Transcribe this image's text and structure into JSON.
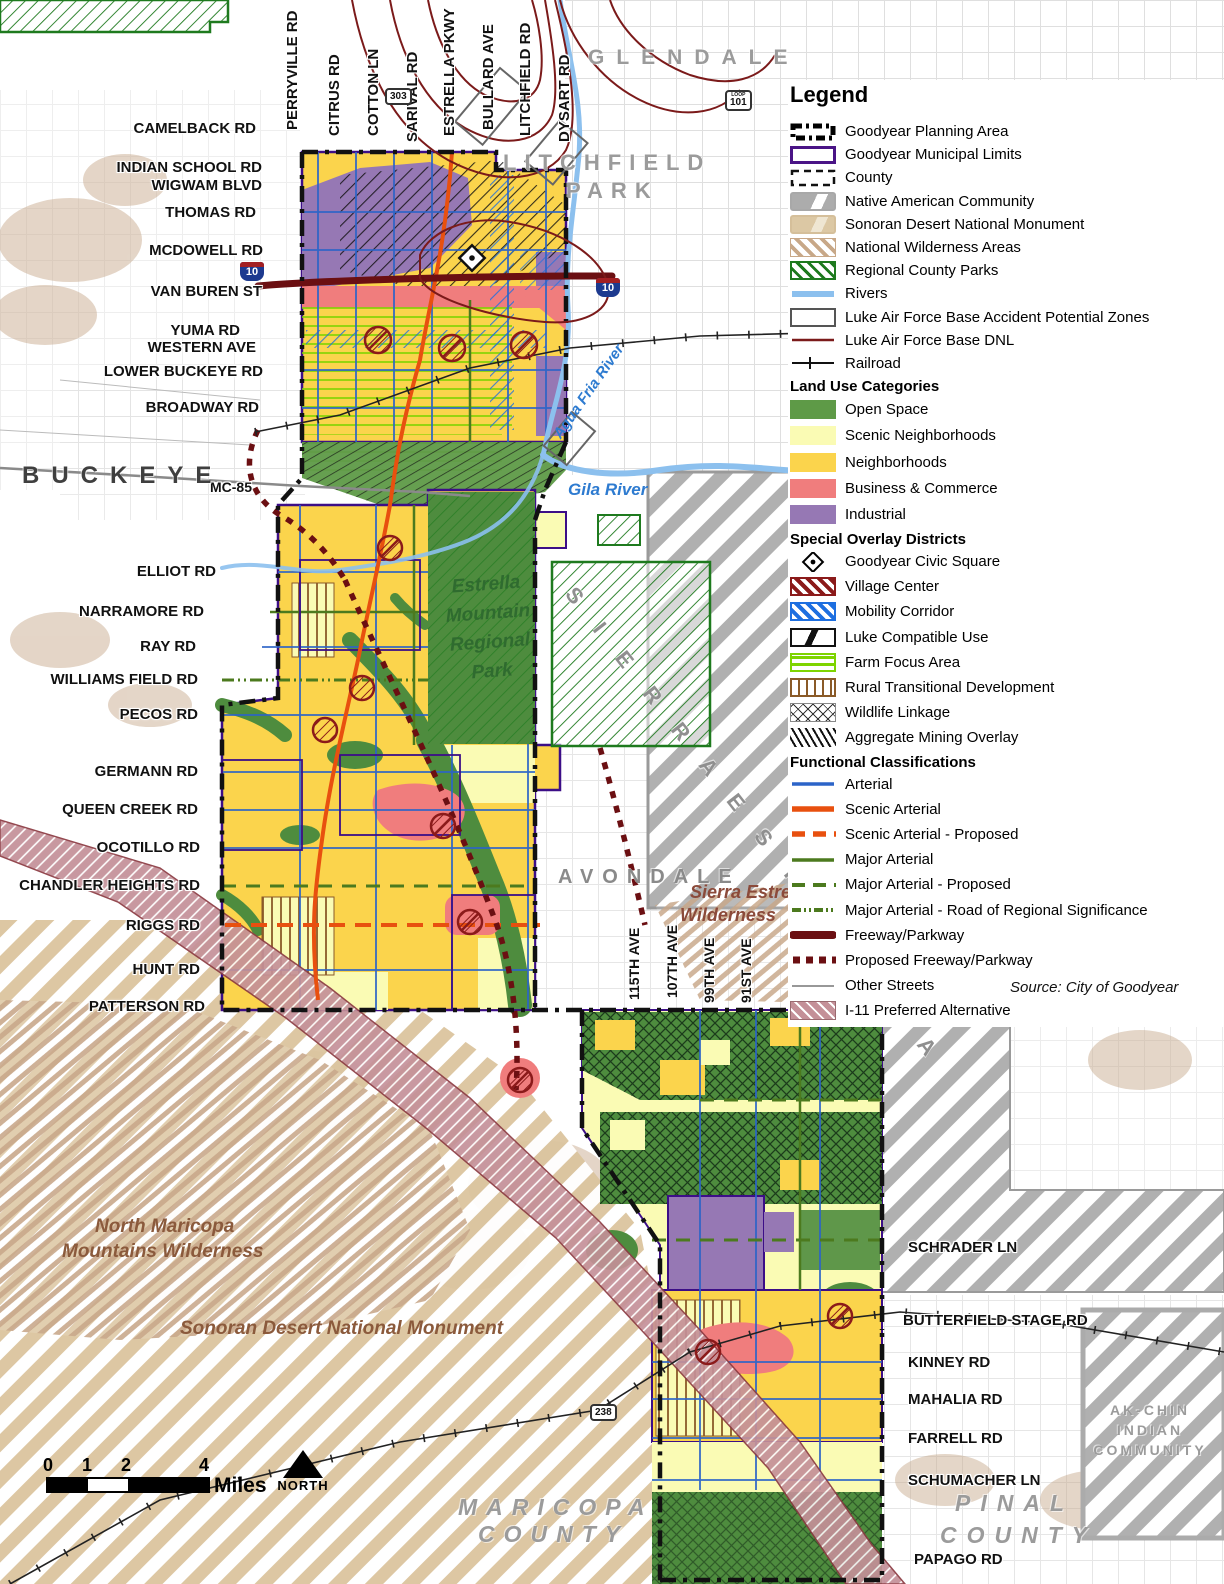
{
  "legend": {
    "title": "Legend",
    "headers": {
      "land_use": "Land Use Categories",
      "overlay": "Special Overlay Districts",
      "functional": "Functional Classifications"
    },
    "items": [
      "Goodyear Planning Area",
      "Goodyear Municipal Limits",
      "County",
      "Native American Community",
      "Sonoran Desert National Monument",
      "National Wilderness Areas",
      "Regional County Parks",
      "Rivers",
      "Luke Air Force Base Accident Potential Zones",
      "Luke Air Force Base DNL",
      "Railroad",
      "Open Space",
      "Scenic Neighborhoods",
      "Neighborhoods",
      "Business & Commerce",
      "Industrial",
      "Goodyear Civic Square",
      "Village Center",
      "Mobility Corridor",
      "Luke Compatible Use",
      "Farm Focus Area",
      "Rural Transitional Development",
      "Wildlife Linkage",
      "Aggregate Mining Overlay",
      "Arterial",
      "Scenic Arterial",
      "Scenic Arterial - Proposed",
      "Major Arterial",
      "Major Arterial - Proposed",
      "Major Arterial - Road of Regional Significance",
      "Freeway/Parkway",
      "Proposed Freeway/Parkway",
      "Other Streets",
      "I-11 Preferred Alternative"
    ]
  },
  "source": "Source: City of Goodyear",
  "colors": {
    "open_space": "#5E9A47",
    "scenic_neighborhoods": "#FAFBB4",
    "neighborhoods": "#FBD44C",
    "business_commerce": "#F07D7D",
    "industrial": "#9678B4",
    "river": "#8CC0EE",
    "arterial": "#2C64C8",
    "scenic_arterial": "#E8500F",
    "major_arterial": "#4C7A1E",
    "freeway": "#6B0F12",
    "luke_dnl": "#7B1A1A",
    "i11_corridor": "#C49098",
    "municipal_limits": "#3C0E87"
  },
  "roads_left": [
    "CAMELBACK RD",
    "INDIAN SCHOOL RD",
    "WIGWAM BLVD",
    "THOMAS RD",
    "MCDOWELL RD",
    "VAN BUREN ST",
    "YUMA RD",
    "WESTERN AVE",
    "LOWER BUCKEYE RD",
    "BROADWAY RD",
    "MC-85",
    "ELLIOT RD",
    "NARRAMORE RD",
    "RAY RD",
    "WILLIAMS FIELD RD",
    "PECOS RD",
    "GERMANN RD",
    "QUEEN CREEK RD",
    "OCOTILLO RD",
    "CHANDLER HEIGHTS RD",
    "RIGGS RD",
    "HUNT RD",
    "PATTERSON RD"
  ],
  "roads_top": [
    "PERRYVILLE RD",
    "CITRUS RD",
    "COTTON LN",
    "SARIVAL RD",
    "ESTRELLA PKWY",
    "BULLARD AVE",
    "LITCHFIELD RD",
    "DYSART RD"
  ],
  "aves_south": [
    "115TH AVE",
    "107TH AVE",
    "99TH AVE",
    "91ST AVE"
  ],
  "roads_right": [
    "SCHRADER LN",
    "BUTTERFIELD STAGE RD",
    "KINNEY RD",
    "MAHALIA RD",
    "FARRELL RD",
    "SCHUMACHER LN",
    "PAPAGO RD"
  ],
  "places": {
    "glendale": "GLENDALE",
    "litchfield1": "LITCHFIELD",
    "litchfield2": "PARK",
    "buckeye": "BUCKEYE",
    "avondale": "AVONDALE",
    "maricopa1": "MARICOPA",
    "maricopa2": "COUNTY",
    "pinal1": "PINAL",
    "pinal2": "COUNTY",
    "akchin1": "AK-CHIN",
    "akchin2": "INDIAN",
    "akchin3": "COMMUNITY",
    "sierra": "S I E R R A   E S T R E L L A"
  },
  "features": {
    "agua_fria": "Agua Fria River",
    "gila": "Gila River",
    "park1": "Estrella",
    "park2": "Mountain",
    "park3": "Regional",
    "park4": "Park",
    "sierra_w1": "Sierra Estrella",
    "sierra_w2": "Wilderness",
    "nmm1": "North Maricopa",
    "nmm2": "Mountains Wilderness",
    "sonoran": "Sonoran Desert National Monument"
  },
  "shields": {
    "i10": "10",
    "loop": "LOOP",
    "r101": "101",
    "r303": "303",
    "r238": "238"
  },
  "scalebar": {
    "t0": "0",
    "t1": "1",
    "t2": "2",
    "t4": "4",
    "unit": "Miles",
    "north": "NORTH"
  }
}
